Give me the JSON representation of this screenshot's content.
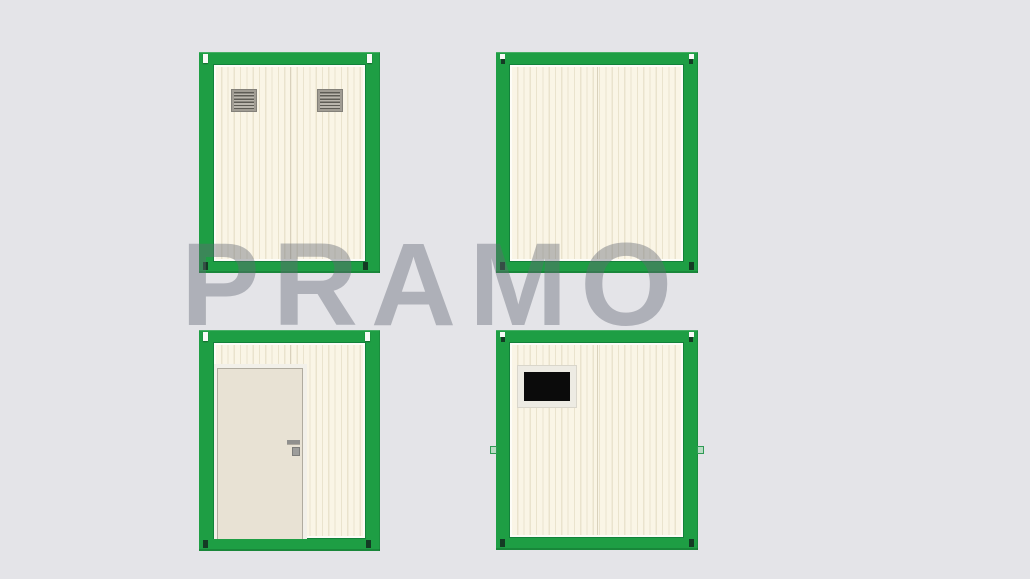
{
  "canvas": {
    "width": 1030,
    "height": 579
  },
  "watermark": {
    "text": "PRAMO",
    "color": "#646a74",
    "opacity": 0.42
  },
  "colors": {
    "background": "#e4e4e8",
    "frame_green": "#1e9e44",
    "frame_green_dark": "#12813a",
    "panel_cream": "#faf5e6",
    "rib_line": "#eae3cd",
    "inner_margin": "#fdfcf7",
    "door_fill": "#e8e2d4",
    "door_frame": "#f2f0e9",
    "door_edge": "#b0ab9f",
    "window_frame": "#edebe3",
    "window_black": "#0b0b0b",
    "vent_frame": "#a19d94",
    "slot_dark": "#143b24",
    "slot_white": "#f8faf7",
    "tab_light_green": "#b9dcc4",
    "handle_gray": "#90908e"
  },
  "views": [
    {
      "position": "top-left",
      "label": "container-elevation-with-vents",
      "features": [
        "vent-grille-left",
        "vent-grille-right"
      ]
    },
    {
      "position": "top-right",
      "label": "container-elevation-plain",
      "features": []
    },
    {
      "position": "bottom-left",
      "label": "container-elevation-with-door",
      "features": [
        "door",
        "door-handle"
      ]
    },
    {
      "position": "bottom-right",
      "label": "container-elevation-with-window",
      "features": [
        "blacked-out-window",
        "side-tabs"
      ]
    }
  ]
}
